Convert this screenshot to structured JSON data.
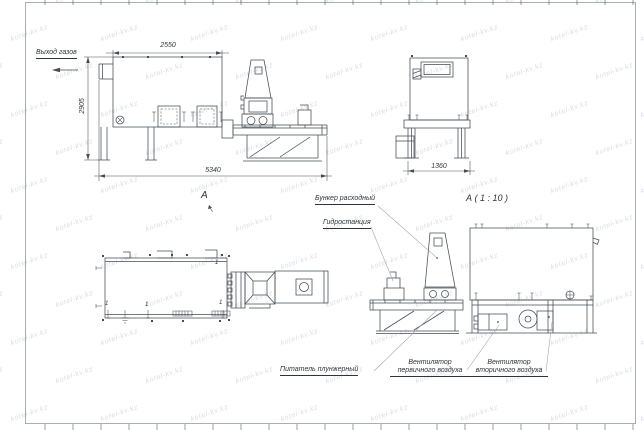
{
  "sheet": {
    "watermark_text": "kotel-kv.kz"
  },
  "colors": {
    "line": "#454c55",
    "dim": "#454c55",
    "leader": "#9aa0a6",
    "watermark": "#b3bbca",
    "frame": "#a8aeb5",
    "text": "#2e343b"
  },
  "side_view": {
    "gas_outlet_label": "Выход газов",
    "dim_top": "2550",
    "dim_left": "2905",
    "dim_bottom": "5340"
  },
  "end_view": {
    "dim_bottom": "1360"
  },
  "plan_view": {
    "view_letter": "А",
    "position_mark": "1"
  },
  "detail_view": {
    "title": "А ( 1 : 10 )",
    "labels": {
      "hopper": "Бункер расходный",
      "hydrostation": "Гидростанция",
      "feeder": "Питатель плунжерный",
      "fan_primary_line1": "Вентилятор",
      "fan_primary_line2": "первичного воздуха",
      "fan_secondary_line1": "Вентилятор",
      "fan_secondary_line2": "вторичного воздуха"
    }
  }
}
